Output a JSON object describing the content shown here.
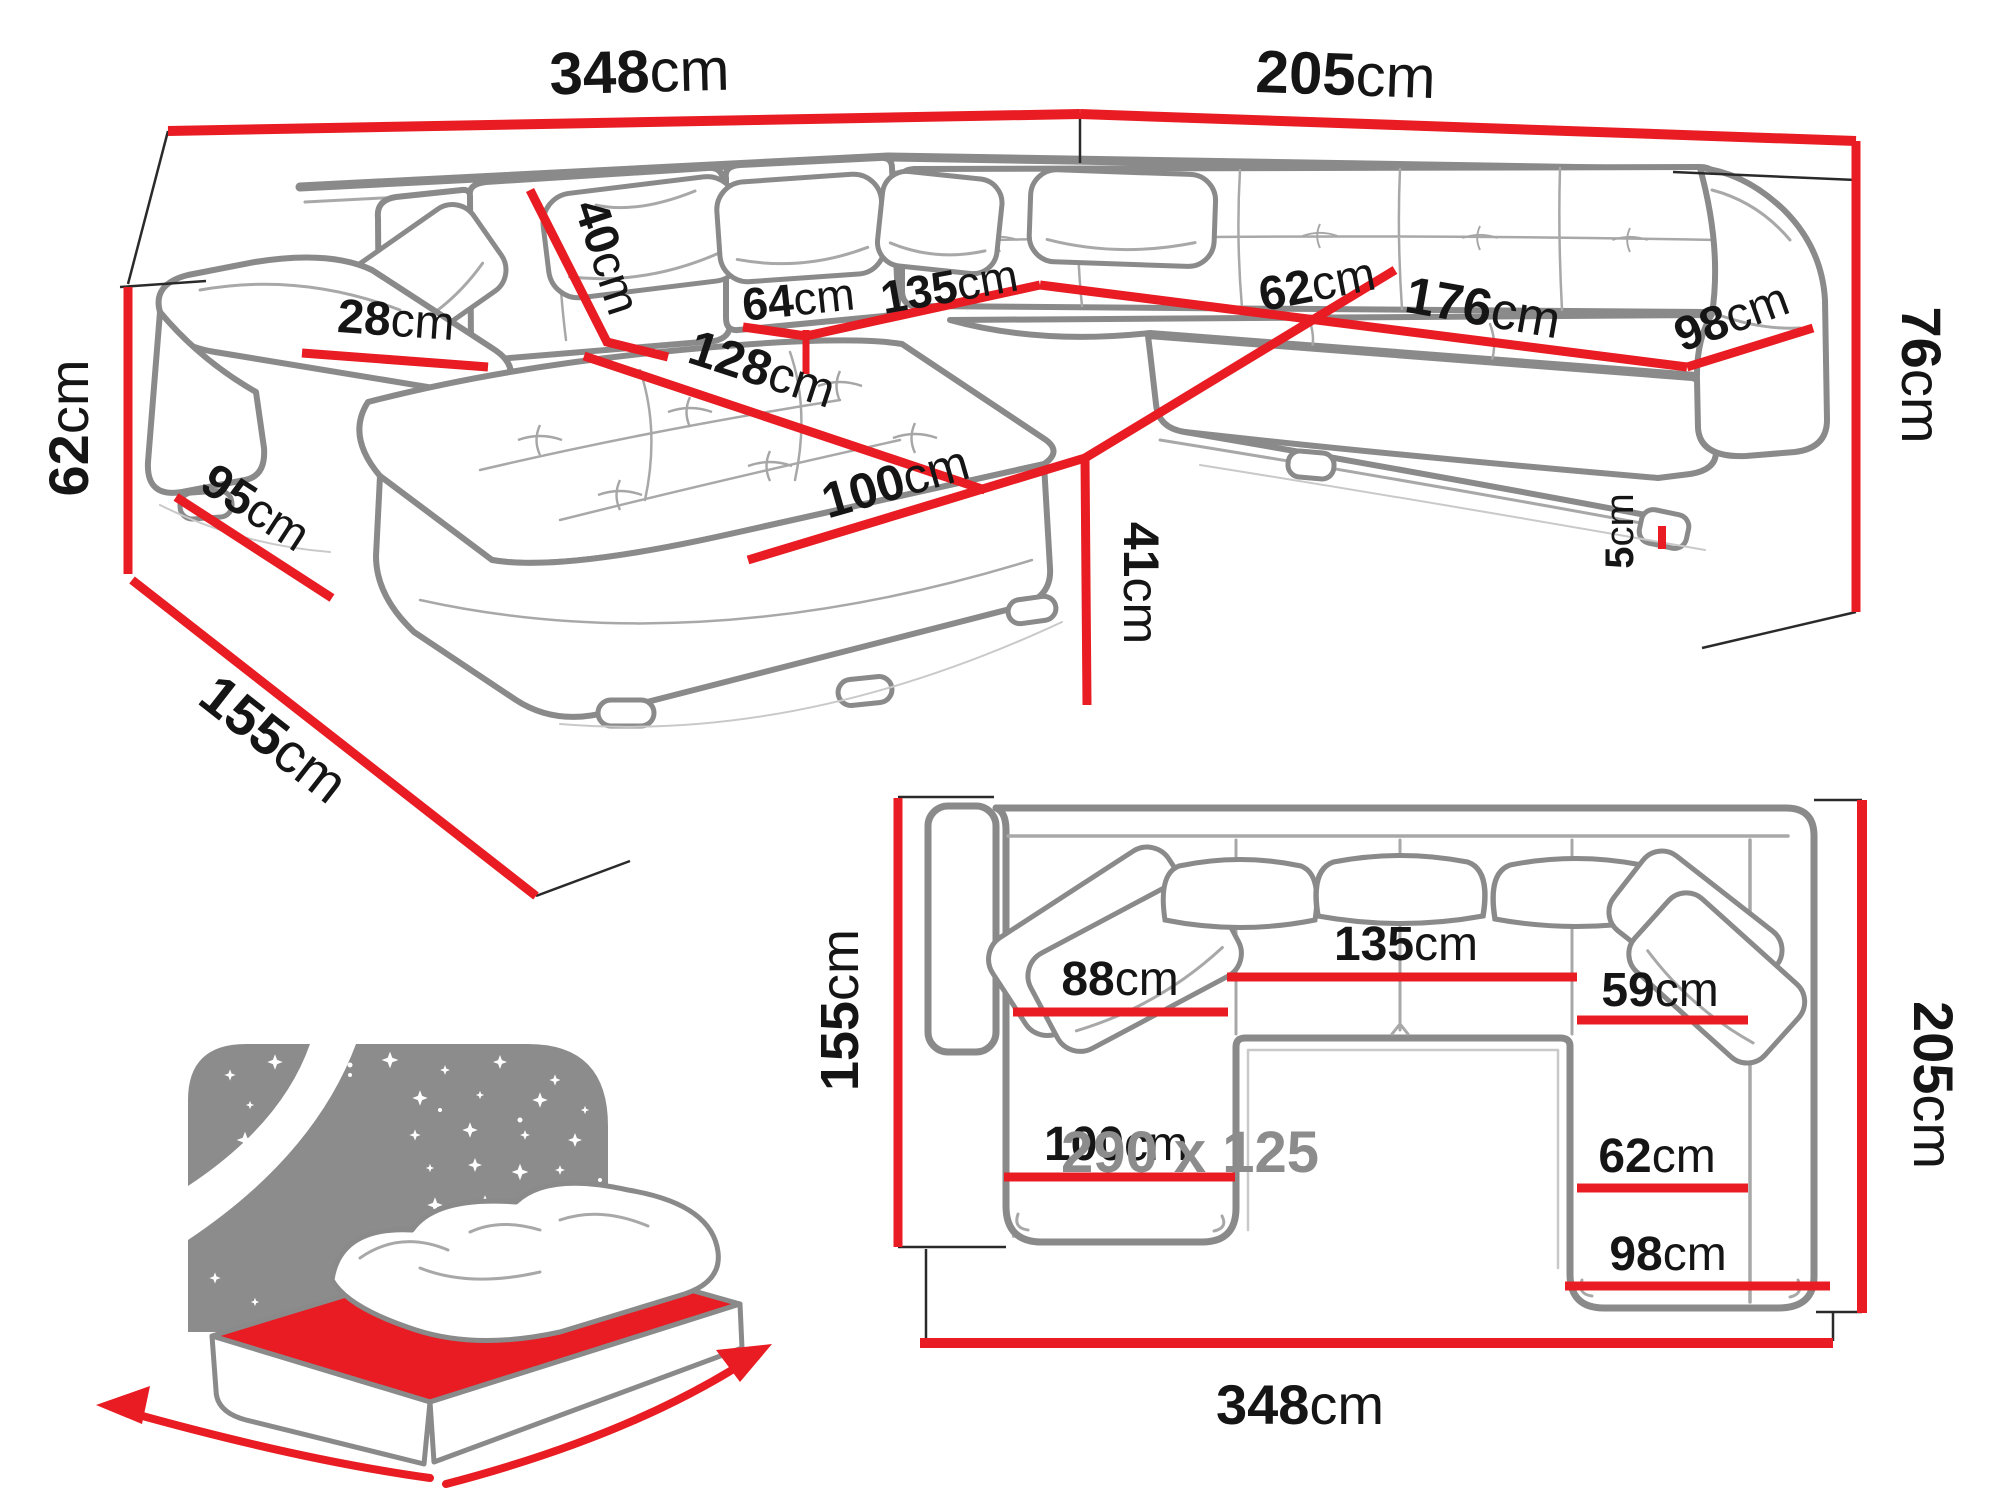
{
  "colors": {
    "dimension_red": "#e81c22",
    "sketch_gray": "#8a8a8a",
    "label_black": "#151515",
    "bed_gray": "#8c8c8c"
  },
  "perspective_view": {
    "dims": {
      "back_width": {
        "v": "348",
        "u": "cm"
      },
      "side_width": {
        "v": "205",
        "u": "cm"
      },
      "back_height": {
        "v": "76",
        "u": "cm"
      },
      "arm_height": {
        "v": "62",
        "u": "cm"
      },
      "chaise_depth": {
        "v": "155",
        "u": "cm"
      },
      "arm_side": {
        "v": "95",
        "u": "cm"
      },
      "arm_top": {
        "v": "28",
        "u": "cm"
      },
      "cushion_height": {
        "v": "40",
        "u": "cm"
      },
      "seat_64": {
        "v": "64",
        "u": "cm"
      },
      "seat_135": {
        "v": "135",
        "u": "cm"
      },
      "chaise_length": {
        "v": "128",
        "u": "cm"
      },
      "chaise_width": {
        "v": "100",
        "u": "cm"
      },
      "seat_height": {
        "v": "41",
        "u": "cm"
      },
      "seat_depth": {
        "v": "62",
        "u": "cm"
      },
      "right_length": {
        "v": "176",
        "u": "cm"
      },
      "right_width": {
        "v": "98",
        "u": "cm"
      },
      "leg_height": {
        "v": "5",
        "u": "cm"
      }
    }
  },
  "top_view": {
    "dims": {
      "chaise_depth": {
        "v": "155",
        "u": "cm"
      },
      "chaise_seat": {
        "v": "88",
        "u": "cm"
      },
      "middle_seat": {
        "v": "135",
        "u": "cm"
      },
      "right_front": {
        "v": "59",
        "u": "cm"
      },
      "right_depth": {
        "v": "62",
        "u": "cm"
      },
      "chaise_width": {
        "v": "100",
        "u": "cm"
      },
      "right_width": {
        "v": "98",
        "u": "cm"
      },
      "total_width": {
        "v": "348",
        "u": "cm"
      },
      "total_depth": {
        "v": "205",
        "u": "cm"
      }
    }
  },
  "sleeping_area": {
    "label": "290 x 125"
  }
}
